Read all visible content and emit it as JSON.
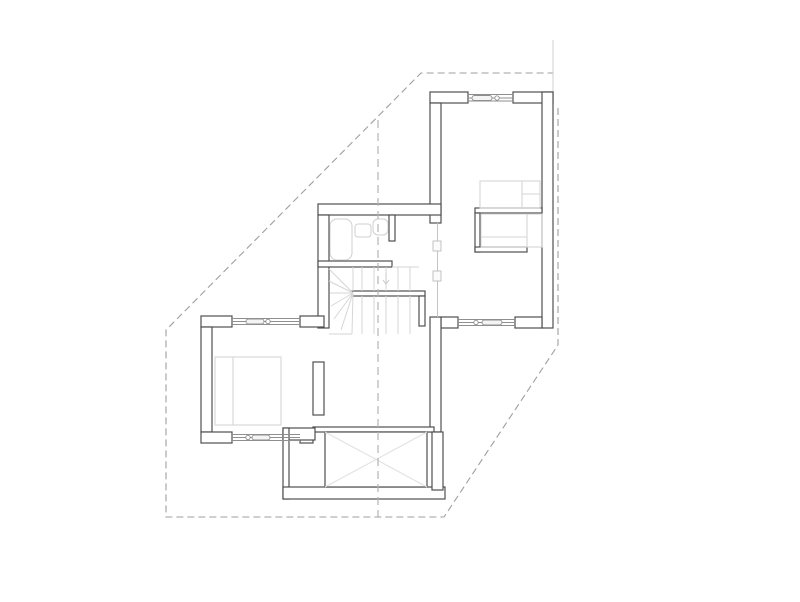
{
  "canvas": {
    "width": 800,
    "height": 602
  },
  "drawing": {
    "type": "architectural-floor-plan",
    "visible_text": "",
    "elements": [
      "site-boundary",
      "plot-edge-line",
      "section-line",
      "exterior-walls",
      "windows",
      "glass-partition",
      "staircase",
      "bathroom-fixtures",
      "beds",
      "wardrobe",
      "void-terrace-x"
    ],
    "window_count": 4,
    "bed_count": 2,
    "stair_type": "u-shaped-winder"
  },
  "colors": {
    "wall_outline": "#4f4f4f",
    "wall_fill": "#ffffff",
    "furniture_line": "#d6d6d6",
    "fixture_line": "#cfcfcf",
    "boundary_dash": "#9f9f9f",
    "section_dash": "#b3b3b3",
    "window_line": "#8f8f8f",
    "partition_line": "#c4c4c4",
    "void_cross": "#e3e3e3",
    "background": "#ffffff",
    "plot_edge": "#cfcfcf"
  }
}
